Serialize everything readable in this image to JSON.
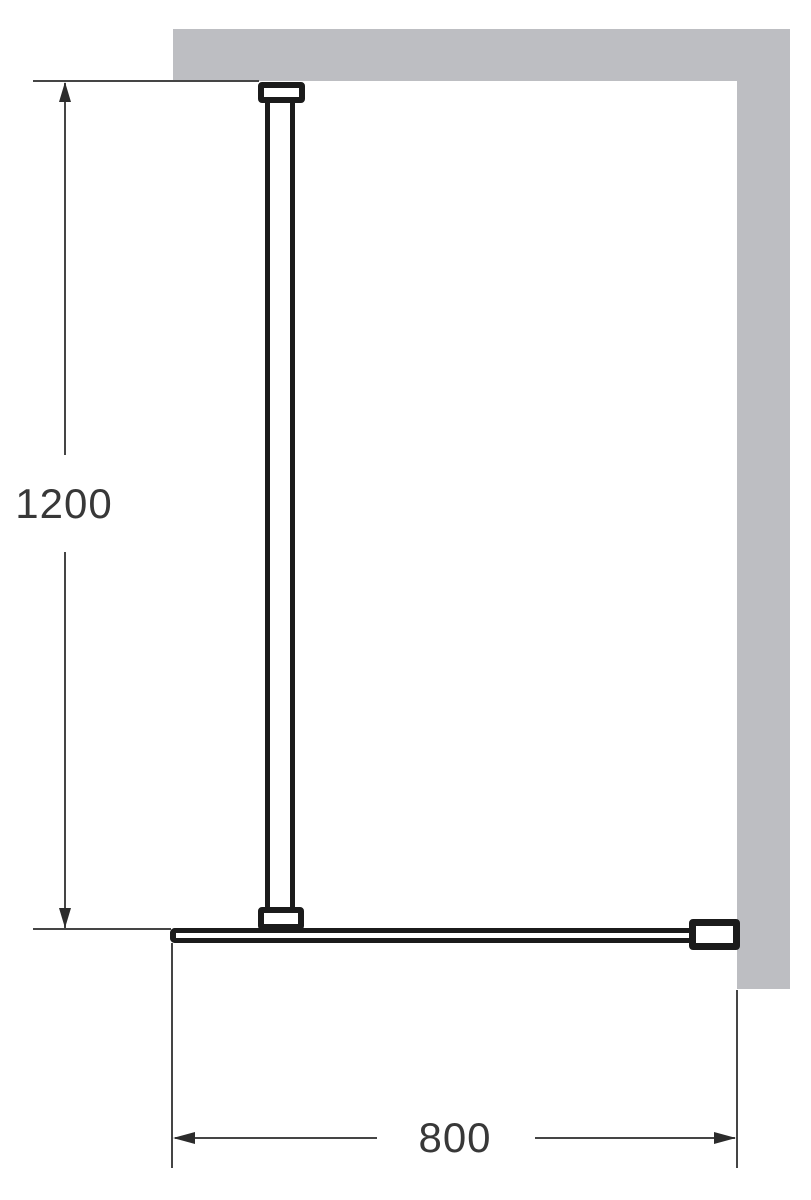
{
  "diagram": {
    "kind": "technical-installation-drawing",
    "vertical_dimension": {
      "label": "1200"
    },
    "horizontal_dimension": {
      "label": "800"
    },
    "colors": {
      "wall_fill": "#bdbec2",
      "profile_black": "#1b1b1b",
      "dimension_line": "#454545",
      "label_text": "#383838",
      "background": "#ffffff"
    }
  }
}
